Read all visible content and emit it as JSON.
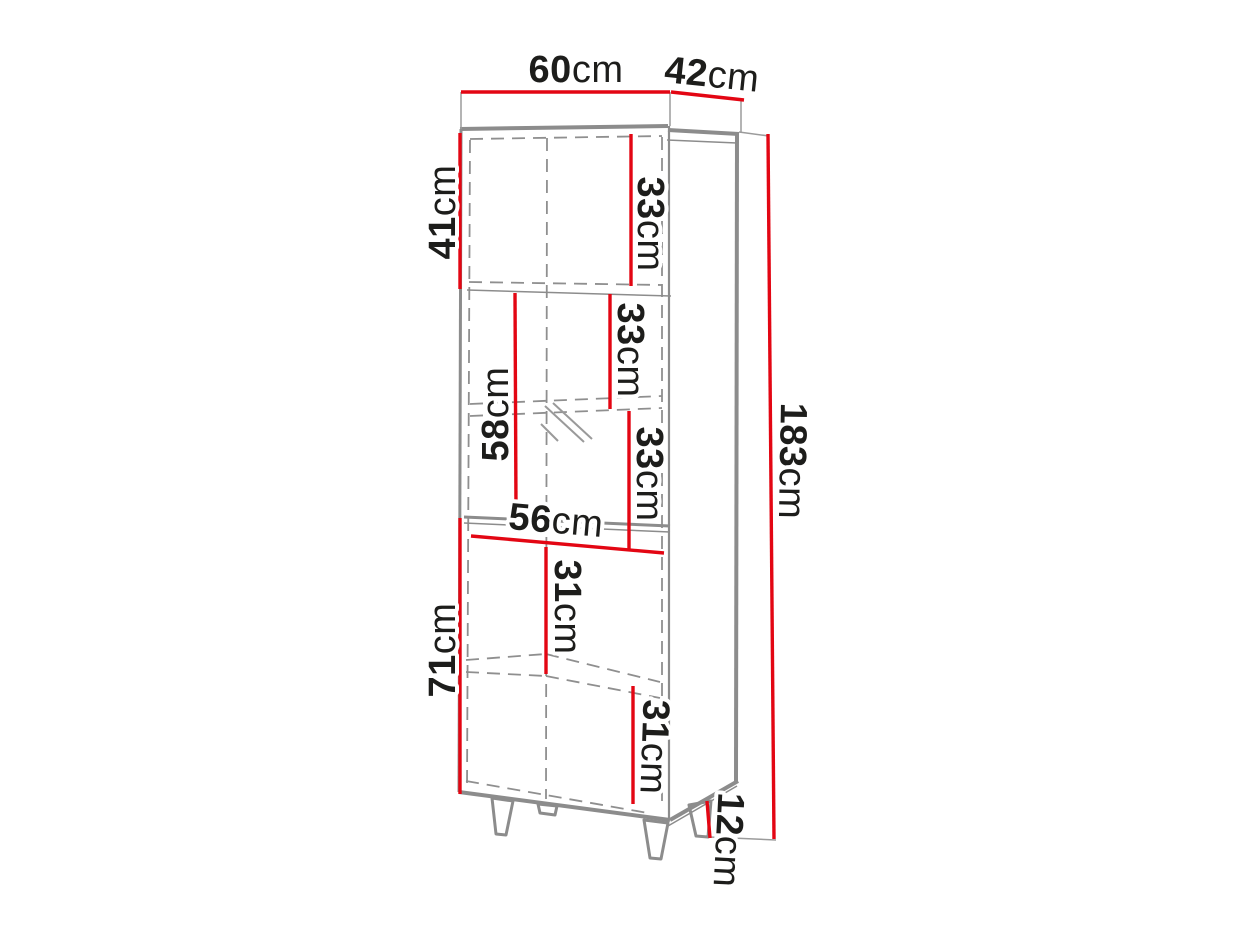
{
  "diagram": {
    "type": "furniture-dimension-drawing",
    "subject": "tall display cabinet on legs",
    "unit": "cm",
    "colors": {
      "dimension_line": "#e30613",
      "cabinet_edge": "#8c8c8c",
      "hidden_edge_dashed": "#8f8f8f",
      "label_text": "#1d1d1b",
      "background": "#ffffff"
    },
    "dimensions": {
      "width": {
        "value": "60",
        "unit": "cm"
      },
      "depth": {
        "value": "42",
        "unit": "cm"
      },
      "upper_section": {
        "value": "41",
        "unit": "cm"
      },
      "shelf_top": {
        "value": "33",
        "unit": "cm"
      },
      "shelf_upper_mid": {
        "value": "33",
        "unit": "cm"
      },
      "display_section": {
        "value": "58",
        "unit": "cm"
      },
      "shelf_lower_mid": {
        "value": "33",
        "unit": "cm"
      },
      "inner_width": {
        "value": "56",
        "unit": "cm"
      },
      "shelf_lower": {
        "value": "31",
        "unit": "cm"
      },
      "lower_section": {
        "value": "71",
        "unit": "cm"
      },
      "shelf_bottom": {
        "value": "31",
        "unit": "cm"
      },
      "total_height": {
        "value": "183",
        "unit": "cm"
      },
      "leg_height": {
        "value": "12",
        "unit": "cm"
      }
    }
  }
}
